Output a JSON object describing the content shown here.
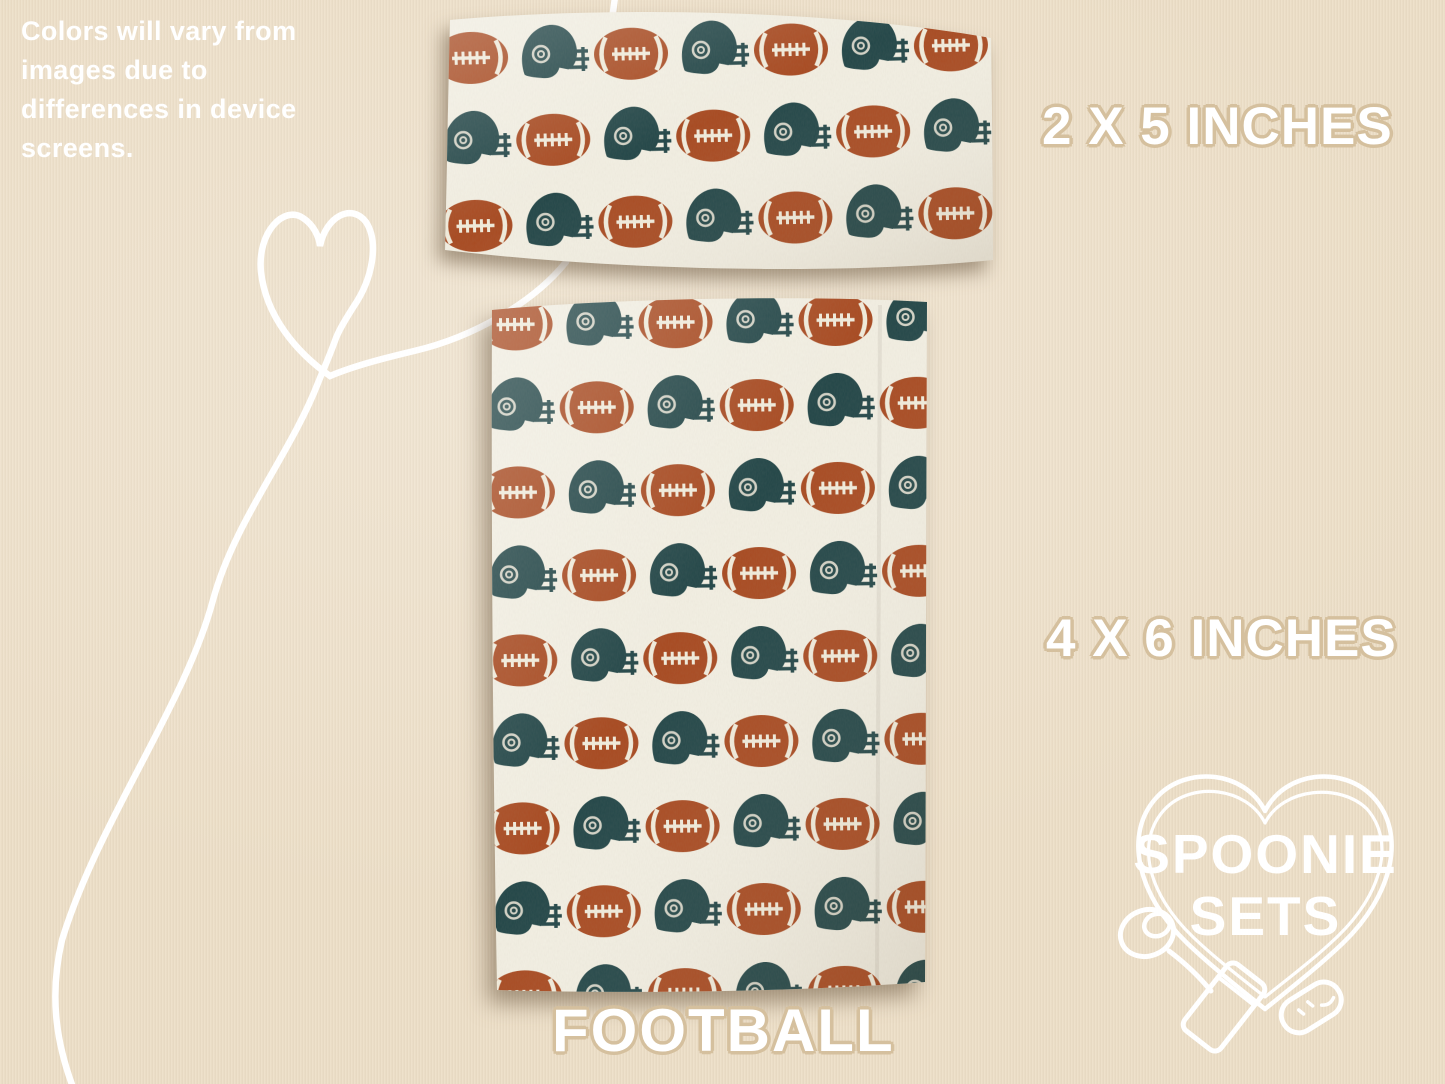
{
  "note": {
    "lines": [
      "Colors will vary from",
      "images due to",
      "differences in device",
      "screens."
    ]
  },
  "labels": {
    "strip_size": "2 X 5 INCHES",
    "swatch_size": "4 X 6 INCHES",
    "pattern_name": "FOOTBALL"
  },
  "logo": {
    "line1": "SPOONIE",
    "line2": "SETS"
  },
  "pattern": {
    "name": "Football",
    "motifs": [
      "football",
      "helmet"
    ],
    "fabric_pieces": [
      {
        "size_label": "2 X 5 INCHES"
      },
      {
        "size_label": "4 X 6 INCHES"
      }
    ]
  },
  "colors": {
    "bg": "#EDDFC8",
    "outline": "#D5C09E",
    "white": "#FFFFFF",
    "fabric": "#F3F0E4",
    "football": "#A84A21",
    "lace": "#F2EDDD",
    "helmet": "#224648",
    "shadow": "rgba(92,71,48,0.5)"
  }
}
